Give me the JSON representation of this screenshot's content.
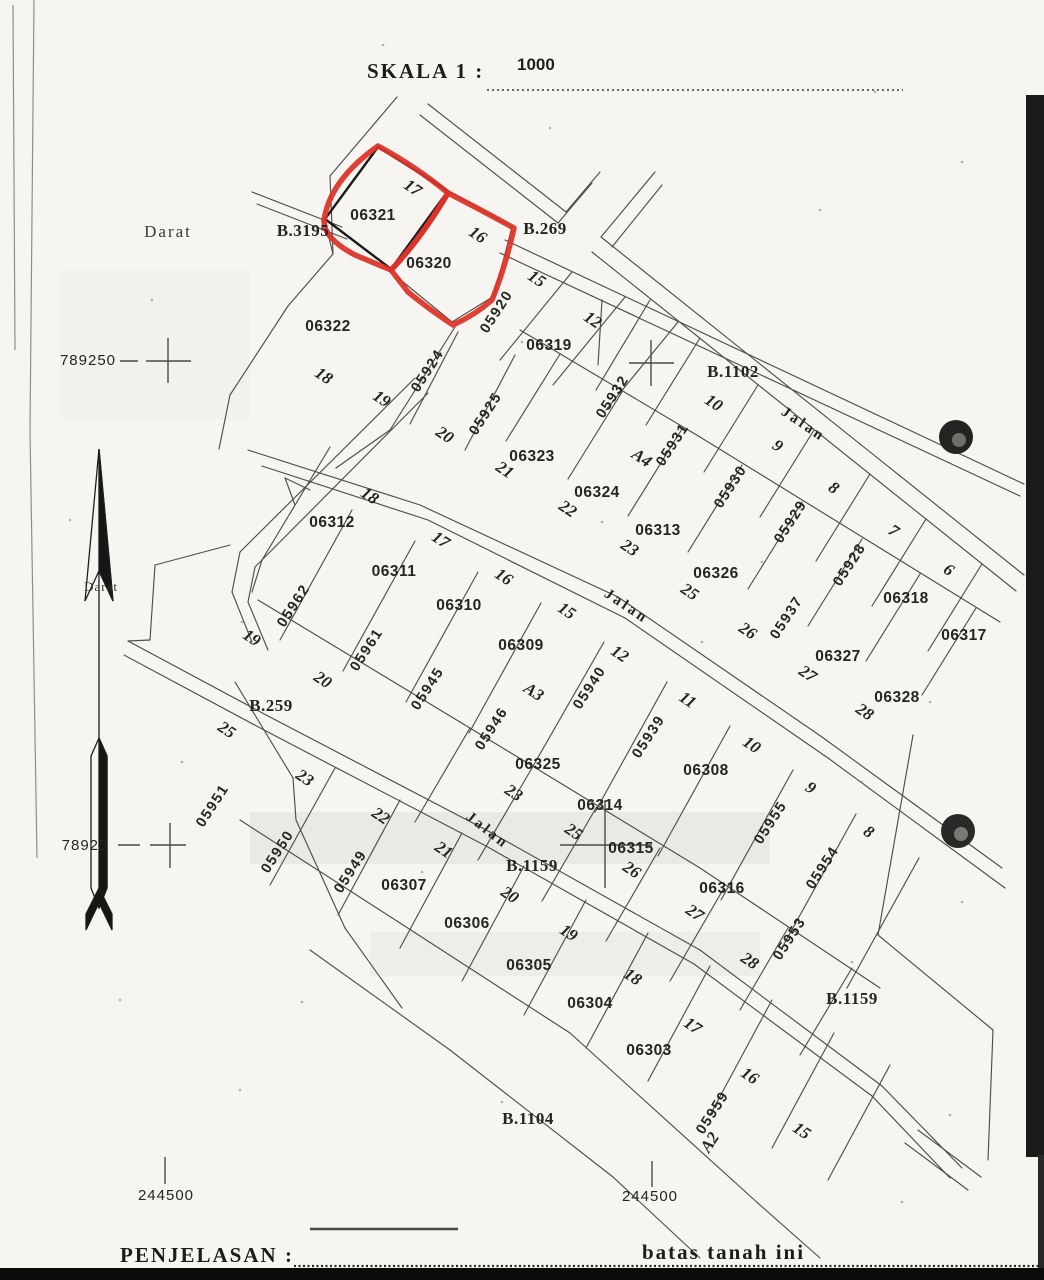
{
  "scale": {
    "label": "SKALA 1 :",
    "value": "1000"
  },
  "legend": {
    "penjelasan_label": "PENJELASAN :",
    "batas_label": "batas tanah ini"
  },
  "colors": {
    "highlight_red": "#dc3228",
    "paper": "#f6f5f1",
    "line": "#4f4e4a",
    "ink": "#262522"
  },
  "highlighted_parcels": [
    "06321",
    "06320"
  ],
  "map": {
    "labels": [
      {
        "t": "Darat",
        "x": 168,
        "y": 233,
        "c": "area"
      },
      {
        "t": "Darat",
        "x": 101,
        "y": 588,
        "c": "areasm"
      },
      {
        "t": "B.3195",
        "x": 303,
        "y": 232,
        "c": "block"
      },
      {
        "t": "B.269",
        "x": 545,
        "y": 230,
        "c": "block"
      },
      {
        "t": "B.1102",
        "x": 733,
        "y": 373,
        "c": "block"
      },
      {
        "t": "B.259",
        "x": 271,
        "y": 707,
        "c": "block"
      },
      {
        "t": "B.1159",
        "x": 532,
        "y": 867,
        "c": "block"
      },
      {
        "t": "B.1159",
        "x": 852,
        "y": 1000,
        "c": "block"
      },
      {
        "t": "B.1104",
        "x": 528,
        "y": 1120,
        "c": "block"
      },
      {
        "t": "Jalan",
        "x": 803,
        "y": 425,
        "r": 34,
        "c": "road"
      },
      {
        "t": "Jalan",
        "x": 626,
        "y": 607,
        "r": 34,
        "c": "road"
      },
      {
        "t": "Jalan",
        "x": 487,
        "y": 831,
        "r": 38,
        "c": "road"
      },
      {
        "t": "06321",
        "x": 373,
        "y": 216,
        "c": "parcel"
      },
      {
        "t": "06320",
        "x": 429,
        "y": 264,
        "c": "parcel"
      },
      {
        "t": "06322",
        "x": 328,
        "y": 327,
        "c": "parcel"
      },
      {
        "t": "06319",
        "x": 549,
        "y": 346,
        "c": "parcel"
      },
      {
        "t": "06323",
        "x": 532,
        "y": 457,
        "c": "parcel"
      },
      {
        "t": "06324",
        "x": 597,
        "y": 493,
        "c": "parcel"
      },
      {
        "t": "06313",
        "x": 658,
        "y": 531,
        "c": "parcel"
      },
      {
        "t": "06326",
        "x": 716,
        "y": 574,
        "c": "parcel"
      },
      {
        "t": "06312",
        "x": 332,
        "y": 523,
        "c": "parcel"
      },
      {
        "t": "06311",
        "x": 394,
        "y": 572,
        "c": "parcel"
      },
      {
        "t": "06310",
        "x": 459,
        "y": 606,
        "c": "parcel"
      },
      {
        "t": "06309",
        "x": 521,
        "y": 646,
        "c": "parcel"
      },
      {
        "t": "06325",
        "x": 538,
        "y": 765,
        "c": "parcel"
      },
      {
        "t": "06314",
        "x": 600,
        "y": 806,
        "c": "parcel"
      },
      {
        "t": "06308",
        "x": 706,
        "y": 771,
        "c": "parcel"
      },
      {
        "t": "06315",
        "x": 631,
        "y": 849,
        "c": "parcel"
      },
      {
        "t": "06316",
        "x": 722,
        "y": 889,
        "c": "parcel"
      },
      {
        "t": "06318",
        "x": 906,
        "y": 599,
        "c": "parcel"
      },
      {
        "t": "06317",
        "x": 964,
        "y": 636,
        "c": "parcel"
      },
      {
        "t": "06327",
        "x": 838,
        "y": 657,
        "c": "parcel"
      },
      {
        "t": "06328",
        "x": 897,
        "y": 698,
        "c": "parcel"
      },
      {
        "t": "06307",
        "x": 404,
        "y": 886,
        "c": "parcel"
      },
      {
        "t": "06306",
        "x": 467,
        "y": 924,
        "c": "parcel"
      },
      {
        "t": "06305",
        "x": 529,
        "y": 966,
        "c": "parcel"
      },
      {
        "t": "06304",
        "x": 590,
        "y": 1004,
        "c": "parcel"
      },
      {
        "t": "06303",
        "x": 649,
        "y": 1051,
        "c": "parcel"
      },
      {
        "t": "17",
        "x": 412,
        "y": 189,
        "r": 34,
        "c": "plot"
      },
      {
        "t": "16",
        "x": 477,
        "y": 236,
        "r": 34,
        "c": "plot"
      },
      {
        "t": "15",
        "x": 536,
        "y": 280,
        "r": 34,
        "c": "plot"
      },
      {
        "t": "12",
        "x": 592,
        "y": 321,
        "r": 34,
        "c": "plot"
      },
      {
        "t": "18",
        "x": 323,
        "y": 377,
        "r": 34,
        "c": "plot"
      },
      {
        "t": "19",
        "x": 381,
        "y": 400,
        "r": 34,
        "c": "plot"
      },
      {
        "t": "20",
        "x": 444,
        "y": 436,
        "r": 34,
        "c": "plot"
      },
      {
        "t": "21",
        "x": 504,
        "y": 471,
        "r": 34,
        "c": "plot"
      },
      {
        "t": "22",
        "x": 567,
        "y": 510,
        "r": 34,
        "c": "plot"
      },
      {
        "t": "23",
        "x": 629,
        "y": 549,
        "r": 34,
        "c": "plot"
      },
      {
        "t": "25",
        "x": 689,
        "y": 593,
        "r": 34,
        "c": "plot"
      },
      {
        "t": "26",
        "x": 747,
        "y": 632,
        "r": 34,
        "c": "plot"
      },
      {
        "t": "27",
        "x": 807,
        "y": 675,
        "r": 34,
        "c": "plot"
      },
      {
        "t": "28",
        "x": 864,
        "y": 713,
        "r": 34,
        "c": "plot"
      },
      {
        "t": "10",
        "x": 713,
        "y": 404,
        "r": 34,
        "c": "plot"
      },
      {
        "t": "9",
        "x": 777,
        "y": 447,
        "r": 34,
        "c": "plot"
      },
      {
        "t": "8",
        "x": 833,
        "y": 489,
        "r": 34,
        "c": "plot"
      },
      {
        "t": "7",
        "x": 893,
        "y": 532,
        "r": 34,
        "c": "plot"
      },
      {
        "t": "6",
        "x": 948,
        "y": 571,
        "r": 34,
        "c": "plot"
      },
      {
        "t": "A4",
        "x": 641,
        "y": 459,
        "r": 34,
        "c": "plot"
      },
      {
        "t": "A3",
        "x": 533,
        "y": 693,
        "r": 34,
        "c": "plot"
      },
      {
        "t": "A2",
        "x": 711,
        "y": 1143,
        "r": -57,
        "c": "plot"
      },
      {
        "t": "18",
        "x": 369,
        "y": 497,
        "r": 34,
        "c": "plot"
      },
      {
        "t": "17",
        "x": 440,
        "y": 541,
        "r": 34,
        "c": "plot"
      },
      {
        "t": "16",
        "x": 503,
        "y": 578,
        "r": 34,
        "c": "plot"
      },
      {
        "t": "15",
        "x": 566,
        "y": 612,
        "r": 34,
        "c": "plot"
      },
      {
        "t": "12",
        "x": 619,
        "y": 655,
        "r": 34,
        "c": "plot"
      },
      {
        "t": "11",
        "x": 687,
        "y": 701,
        "r": 34,
        "c": "plot"
      },
      {
        "t": "10",
        "x": 751,
        "y": 746,
        "r": 34,
        "c": "plot"
      },
      {
        "t": "9",
        "x": 810,
        "y": 789,
        "r": 34,
        "c": "plot"
      },
      {
        "t": "8",
        "x": 868,
        "y": 833,
        "r": 34,
        "c": "plot"
      },
      {
        "t": "19",
        "x": 251,
        "y": 639,
        "r": 34,
        "c": "plot"
      },
      {
        "t": "20",
        "x": 322,
        "y": 681,
        "r": 34,
        "c": "plot"
      },
      {
        "t": "25",
        "x": 226,
        "y": 731,
        "r": 34,
        "c": "plot"
      },
      {
        "t": "23",
        "x": 304,
        "y": 779,
        "r": 34,
        "c": "plot"
      },
      {
        "t": "22",
        "x": 380,
        "y": 817,
        "r": 34,
        "c": "plot"
      },
      {
        "t": "21",
        "x": 443,
        "y": 851,
        "r": 34,
        "c": "plot"
      },
      {
        "t": "20",
        "x": 509,
        "y": 896,
        "r": 34,
        "c": "plot"
      },
      {
        "t": "19",
        "x": 568,
        "y": 934,
        "r": 34,
        "c": "plot"
      },
      {
        "t": "18",
        "x": 632,
        "y": 978,
        "r": 34,
        "c": "plot"
      },
      {
        "t": "17",
        "x": 692,
        "y": 1027,
        "r": 34,
        "c": "plot"
      },
      {
        "t": "16",
        "x": 749,
        "y": 1077,
        "r": 34,
        "c": "plot"
      },
      {
        "t": "15",
        "x": 801,
        "y": 1132,
        "r": 34,
        "c": "plot"
      },
      {
        "t": "23",
        "x": 513,
        "y": 794,
        "r": 34,
        "c": "plot"
      },
      {
        "t": "25",
        "x": 573,
        "y": 833,
        "r": 34,
        "c": "plot"
      },
      {
        "t": "26",
        "x": 631,
        "y": 871,
        "r": 34,
        "c": "plot"
      },
      {
        "t": "27",
        "x": 694,
        "y": 914,
        "r": 34,
        "c": "plot"
      },
      {
        "t": "28",
        "x": 749,
        "y": 962,
        "r": 34,
        "c": "plot"
      },
      {
        "t": "05920",
        "x": 497,
        "y": 312,
        "r": -57,
        "c": "nib"
      },
      {
        "t": "05924",
        "x": 428,
        "y": 371,
        "r": -57,
        "c": "nib"
      },
      {
        "t": "05925",
        "x": 486,
        "y": 414,
        "r": -57,
        "c": "nib"
      },
      {
        "t": "05932",
        "x": 613,
        "y": 397,
        "r": -57,
        "c": "nib"
      },
      {
        "t": "05931",
        "x": 673,
        "y": 445,
        "r": -57,
        "c": "nib"
      },
      {
        "t": "05930",
        "x": 731,
        "y": 487,
        "r": -57,
        "c": "nib"
      },
      {
        "t": "05929",
        "x": 791,
        "y": 522,
        "r": -57,
        "c": "nib"
      },
      {
        "t": "05928",
        "x": 850,
        "y": 565,
        "r": -57,
        "c": "nib"
      },
      {
        "t": "05937",
        "x": 787,
        "y": 618,
        "r": -57,
        "c": "nib"
      },
      {
        "t": "05962",
        "x": 294,
        "y": 606,
        "r": -57,
        "c": "nib"
      },
      {
        "t": "05961",
        "x": 367,
        "y": 650,
        "r": -57,
        "c": "nib"
      },
      {
        "t": "05945",
        "x": 428,
        "y": 689,
        "r": -57,
        "c": "nib"
      },
      {
        "t": "05946",
        "x": 492,
        "y": 729,
        "r": -57,
        "c": "nib"
      },
      {
        "t": "05940",
        "x": 590,
        "y": 688,
        "r": -57,
        "c": "nib"
      },
      {
        "t": "05939",
        "x": 649,
        "y": 737,
        "r": -57,
        "c": "nib"
      },
      {
        "t": "05951",
        "x": 213,
        "y": 806,
        "r": -57,
        "c": "nib"
      },
      {
        "t": "05950",
        "x": 278,
        "y": 852,
        "r": -57,
        "c": "nib"
      },
      {
        "t": "05949",
        "x": 351,
        "y": 872,
        "r": -57,
        "c": "nib"
      },
      {
        "t": "05955",
        "x": 771,
        "y": 823,
        "r": -57,
        "c": "nib"
      },
      {
        "t": "05954",
        "x": 823,
        "y": 868,
        "r": -57,
        "c": "nib"
      },
      {
        "t": "05953",
        "x": 790,
        "y": 939,
        "r": -57,
        "c": "nib"
      },
      {
        "t": "05959",
        "x": 713,
        "y": 1113,
        "r": -57,
        "c": "nib"
      },
      {
        "t": "789250",
        "x": 88,
        "y": 361,
        "c": "coord"
      },
      {
        "t": "78925",
        "x": 85,
        "y": 846,
        "c": "coord"
      },
      {
        "t": "244500",
        "x": 166,
        "y": 1196,
        "c": "coord"
      },
      {
        "t": "244500",
        "x": 650,
        "y": 1197,
        "c": "coord"
      }
    ]
  }
}
